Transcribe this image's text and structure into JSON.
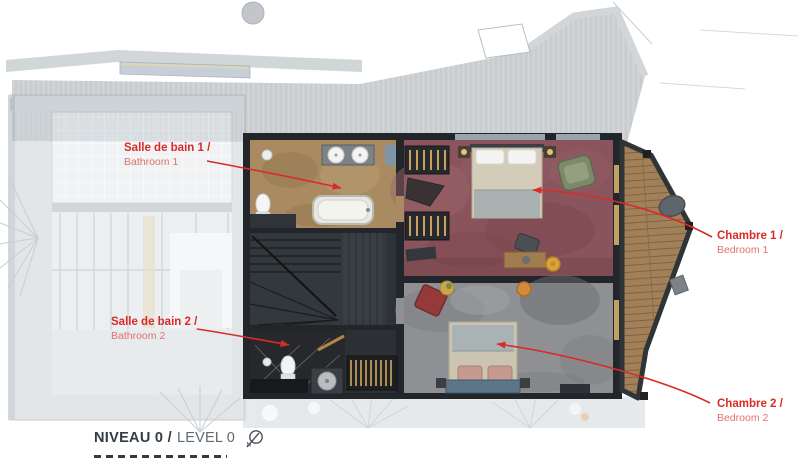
{
  "plan": {
    "annotations": [
      {
        "fr": "Salle de bain 1 /",
        "en": "Bathroom 1"
      },
      {
        "fr": "Salle de bain 2 /",
        "en": "Bathroom 2"
      },
      {
        "fr": "Chambre 1 /",
        "en": "Bedroom 1"
      },
      {
        "fr": "Chambre 2 /",
        "en": "Bedroom 2"
      }
    ],
    "legend": {
      "title_fr": "NIVEAU 0 /",
      "title_en": "LEVEL 0",
      "compass": "N"
    },
    "colors": {
      "annotation_red": "#d92b27",
      "annotation_red_light": "#e2716c",
      "title_dark": "#333b43",
      "title_light": "#606870",
      "bedroom1_carpet": "#8a545c",
      "bedroom2_carpet": "#8e9094",
      "bathroom1_floor": "#a98a61",
      "balcony_wood": "#a2805a",
      "wall_dark": "#22262a"
    }
  }
}
